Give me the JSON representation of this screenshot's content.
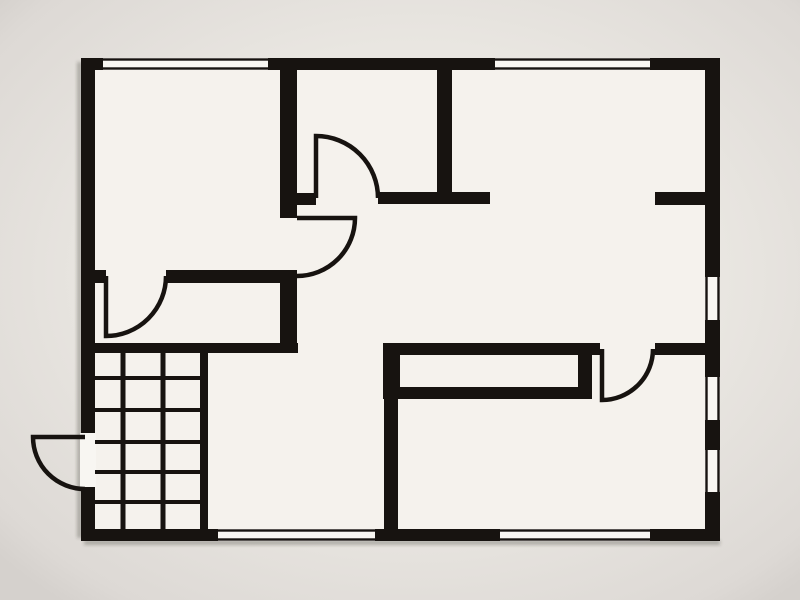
{
  "meta": {
    "description": "black-and-white architectural floor plan, no text labels",
    "canvas": {
      "width": 800,
      "height": 600
    }
  },
  "palette": {
    "background": "#e9e6e1",
    "background_edge": "#d5d1cd",
    "floor": "#f5f2ed",
    "wall": "#171310",
    "window_line": "#171310",
    "window_gap": "#f8f6f2",
    "shadow": "rgba(60,52,45,0.30)"
  },
  "plan": {
    "floor": {
      "x": 81,
      "y": 58,
      "w": 639,
      "h": 483
    },
    "wall_faces": {
      "top": {
        "pos": 58,
        "thick": 12
      },
      "bottom": {
        "pos": 529,
        "thick": 12
      },
      "left": {
        "pos": 81,
        "thick": 14
      },
      "right": {
        "pos": 705,
        "thick": 15
      }
    },
    "walls": [
      {
        "id": "outer-top-wall",
        "x": 81,
        "y": 58,
        "w": 639,
        "h": 12
      },
      {
        "id": "outer-left-wall",
        "x": 81,
        "y": 58,
        "w": 14,
        "h": 483
      },
      {
        "id": "outer-right-wall",
        "x": 705,
        "y": 58,
        "w": 15,
        "h": 483
      },
      {
        "id": "outer-bottom-wall",
        "x": 81,
        "y": 529,
        "w": 639,
        "h": 12
      },
      {
        "id": "tl-room-right-wall",
        "x": 280,
        "y": 70,
        "w": 17,
        "h": 148
      },
      {
        "id": "tl-room-bottom-wall-a",
        "x": 95,
        "y": 270,
        "w": 11,
        "h": 13
      },
      {
        "id": "tl-room-bottom-wall-b",
        "x": 166,
        "y": 270,
        "w": 131,
        "h": 13
      },
      {
        "id": "corridor-right-wall",
        "x": 280,
        "y": 270,
        "w": 17,
        "h": 83
      },
      {
        "id": "stair-top-wall",
        "x": 95,
        "y": 343,
        "w": 203,
        "h": 10
      },
      {
        "id": "hall-top-stub-left",
        "x": 297,
        "y": 193,
        "w": 19,
        "h": 12
      },
      {
        "id": "hall-top-wall",
        "x": 378,
        "y": 192,
        "w": 112,
        "h": 12
      },
      {
        "id": "tc-room-right-wall",
        "x": 437,
        "y": 70,
        "w": 15,
        "h": 134
      },
      {
        "id": "tr-room-stub",
        "x": 655,
        "y": 192,
        "w": 50,
        "h": 13
      },
      {
        "id": "closet-top-wall",
        "x": 383,
        "y": 343,
        "w": 217,
        "h": 12
      },
      {
        "id": "closet-left-wall",
        "x": 383,
        "y": 343,
        "w": 17,
        "h": 56
      },
      {
        "id": "closet-bottom-wall",
        "x": 383,
        "y": 387,
        "w": 209,
        "h": 12
      },
      {
        "id": "closet-right-wall",
        "x": 578,
        "y": 353,
        "w": 14,
        "h": 36
      },
      {
        "id": "rooms-divider-wall",
        "x": 384,
        "y": 399,
        "w": 14,
        "h": 130
      },
      {
        "id": "br-room-top-stub",
        "x": 655,
        "y": 343,
        "w": 50,
        "h": 12
      },
      {
        "id": "stair-right-wall",
        "x": 200,
        "y": 353,
        "w": 8,
        "h": 176
      }
    ],
    "windows": [
      {
        "id": "window-top-left",
        "wall": "top",
        "from": 103,
        "to": 268
      },
      {
        "id": "window-top-center",
        "wall": "top",
        "from": 495,
        "to": 650
      },
      {
        "id": "window-bottom-left",
        "wall": "bottom",
        "from": 218,
        "to": 375
      },
      {
        "id": "window-bottom-right",
        "wall": "bottom",
        "from": 500,
        "to": 650
      },
      {
        "id": "window-right-upper",
        "wall": "right",
        "from": 277,
        "to": 320
      },
      {
        "id": "window-right-middle",
        "wall": "right",
        "from": 377,
        "to": 420
      },
      {
        "id": "window-right-lower",
        "wall": "right",
        "from": 450,
        "to": 492
      }
    ],
    "door_openings": [
      {
        "id": "entry-door-opening",
        "x": 80,
        "y": 433,
        "w": 16,
        "h": 54
      }
    ],
    "doors": [
      {
        "id": "door-top-center-room",
        "path": "M316,198 L316,136 A62,62 0 0 1 378,198"
      },
      {
        "id": "door-tl-room-to-hall",
        "path": "M297,218 L355,218 A58,58 0 0 1 297,276"
      },
      {
        "id": "door-tl-room-to-corridor",
        "path": "M106,276 L106,336 A60,60 0 0 0 166,276"
      },
      {
        "id": "door-entry-exterior",
        "path": "M85,437 L33,437 A52,52 0 0 0 85,489"
      },
      {
        "id": "door-bottom-right-room",
        "path": "M602,349 L602,400 A51,51 0 0 0 653,349"
      }
    ],
    "stairs": {
      "id": "staircase",
      "x0": 95,
      "x1": 200,
      "y0": 353,
      "y1": 529,
      "tread_ys": [
        378,
        410,
        442,
        472,
        502
      ],
      "tread_thickness": 4,
      "riser_xs": [
        123,
        163
      ],
      "riser_thickness": 5
    },
    "shadows": [
      {
        "id": "shadow-bottom",
        "x": 84,
        "y": 540,
        "w": 636,
        "h": 5
      },
      {
        "id": "shadow-left",
        "x": 77,
        "y": 62,
        "w": 5,
        "h": 476
      }
    ]
  }
}
